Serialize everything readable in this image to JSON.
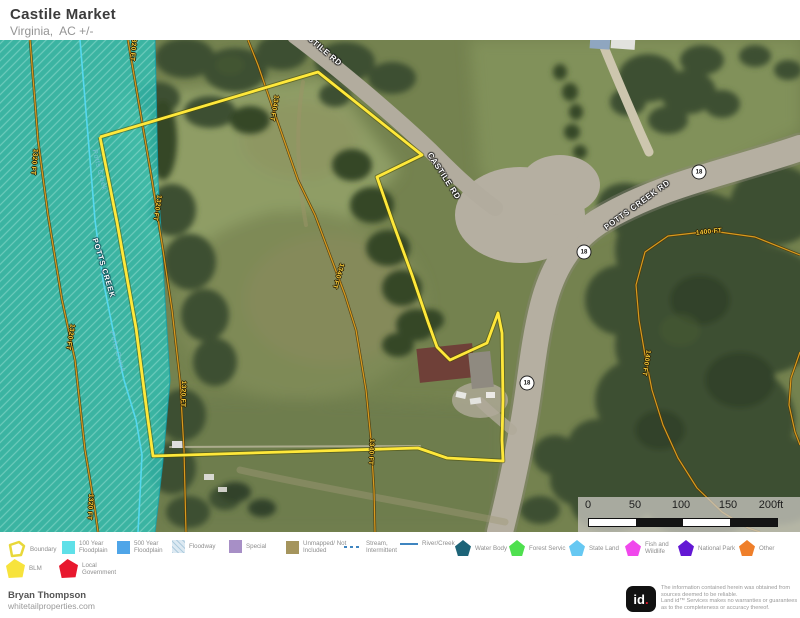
{
  "header": {
    "title": "Castile Market",
    "subtitle": "Virginia,  AC +/-"
  },
  "map": {
    "road_labels": [
      {
        "text": "CASTILE RD",
        "x": 320,
        "y": 7,
        "angle": 40,
        "kind": "road"
      },
      {
        "text": "CASTILE RD",
        "x": 444,
        "y": 136,
        "angle": 57,
        "kind": "road"
      },
      {
        "text": "POTTS CREEK RD",
        "x": 637,
        "y": 165,
        "angle": -36,
        "kind": "road"
      }
    ],
    "water_labels": [
      {
        "text": "POTTS CREEK",
        "x": 104,
        "y": 228,
        "angle": 73,
        "kind": "creek"
      },
      {
        "text": "Potts Creek",
        "x": 99,
        "y": 130,
        "angle": 76,
        "kind": "creek-faint"
      },
      {
        "text": "Potts Creek",
        "x": 117,
        "y": 312,
        "angle": 74,
        "kind": "creek-faint"
      }
    ],
    "contour_labels": [
      {
        "text": "1320 FT",
        "x": 133,
        "y": 8,
        "angle": 95
      },
      {
        "text": "1320 FT",
        "x": 34,
        "y": 122,
        "angle": 96
      },
      {
        "text": "1320 FT",
        "x": 157,
        "y": 168,
        "angle": 99
      },
      {
        "text": "1320 FT",
        "x": 70,
        "y": 297,
        "angle": 100
      },
      {
        "text": "1320 FT",
        "x": 183,
        "y": 354,
        "angle": 92
      },
      {
        "text": "1320 FT",
        "x": 90,
        "y": 467,
        "angle": 94
      },
      {
        "text": "1340 FT",
        "x": 274,
        "y": 68,
        "angle": 100
      },
      {
        "text": "1340 FT",
        "x": 338,
        "y": 236,
        "angle": 107
      },
      {
        "text": "1340 FT",
        "x": 371,
        "y": 412,
        "angle": 93
      },
      {
        "text": "1400 FT",
        "x": 709,
        "y": 192,
        "angle": -6
      },
      {
        "text": "1400 FT",
        "x": 646,
        "y": 323,
        "angle": 99
      }
    ],
    "shields": [
      {
        "label": "18",
        "x": 699,
        "y": 132
      },
      {
        "label": "18",
        "x": 584,
        "y": 212
      },
      {
        "label": "18",
        "x": 527,
        "y": 343
      }
    ],
    "scalebar": {
      "labels": [
        {
          "text": "0",
          "x": 10
        },
        {
          "text": "50",
          "x": 57
        },
        {
          "text": "100",
          "x": 103
        },
        {
          "text": "150",
          "x": 150
        },
        {
          "text": "200ft",
          "x": 193
        }
      ],
      "segments": [
        "#ffffff",
        "#141414",
        "#ffffff",
        "#141414"
      ]
    },
    "geometry": {
      "boundary": {
        "color": "#ffe83a",
        "points": "100,137 318,72 422,155 377,177 393,223 412,275 428,322 437,347 444,354 450,360 487,343 498,313 502,333 503,400 502,440 503,461 447,458 418,448 283,452 153,456 148,420 136,328 117,222 100,137"
      },
      "floodplain": {
        "fill": "#2ec0b4",
        "points": "0,40 155,40 158,180 165,300 170,380 163,460 155,532 0,532",
        "edge": "155,40 158,180 165,300 170,380 163,460 155,532",
        "edge_color": "#0fa3b0"
      },
      "creek": {
        "color": "#55d8ee",
        "points": "80,40 85,100 90,160 95,220 103,280 113,330 124,380 136,420 142,455 140,495 138,532"
      },
      "contours": [
        {
          "elevation": "1320 FT",
          "points": "30,40 38,140 48,215 62,300 75,360 85,450 95,510 98,532"
        },
        {
          "elevation": "1320 FT",
          "points": "128,40 140,110 152,180 163,250 172,310 180,380 184,450 186,532"
        },
        {
          "elevation": "1340 FT",
          "points": "248,40 258,65 270,100 284,140 298,180 315,215 330,255 345,295 356,330 366,390 371,440 374,490 375,532"
        },
        {
          "elevation": "1400 FT",
          "points": "800,255 755,237 712,231 668,236 645,252 636,285 639,320 645,355 652,390 663,425 678,458 697,488 722,512 748,528 760,532"
        },
        {
          "elevation": "1400 FT",
          "points": "800,352 791,378 789,405 795,432 800,445"
        }
      ]
    }
  },
  "legend": {
    "items": [
      {
        "label": "Boundary",
        "shape": "boundary",
        "color": "#e8d83a",
        "x": 6,
        "y": 8,
        "w": 40
      },
      {
        "label": "100 Year Floodplain",
        "shape": "square",
        "color": "#5fe0e8",
        "x": 62,
        "y": 8,
        "w": 40
      },
      {
        "label": "500 Year Floodplain",
        "shape": "square",
        "color": "#4fa5e8",
        "x": 117,
        "y": 8,
        "w": 40
      },
      {
        "label": "Floodway",
        "shape": "square-hatch",
        "color": "#dce9f2",
        "x": 172,
        "y": 8,
        "w": 44
      },
      {
        "label": "Special",
        "shape": "square",
        "color": "#a78fc6",
        "x": 229,
        "y": 8,
        "w": 40
      },
      {
        "label": "Unmapped/ Not Included",
        "shape": "square",
        "color": "#a5955d",
        "x": 286,
        "y": 8,
        "w": 48
      },
      {
        "label": "Stream, Intermittent",
        "shape": "dash-line",
        "color": "#3f85c0",
        "x": 344,
        "y": 8,
        "w": 38
      },
      {
        "label": "River/Creek",
        "shape": "solid-line",
        "color": "#3f85c0",
        "x": 400,
        "y": 8,
        "w": 44
      },
      {
        "label": "Water Body",
        "shape": "pentagon",
        "color": "#1d6478",
        "x": 455,
        "y": 8,
        "w": 40
      },
      {
        "label": "Forest Servic",
        "shape": "pentagon",
        "color": "#4fe04f",
        "x": 509,
        "y": 8,
        "w": 56
      },
      {
        "label": "State Land",
        "shape": "pentagon",
        "color": "#66c8f2",
        "x": 569,
        "y": 8,
        "w": 44
      },
      {
        "label": "Fish and Wildlife",
        "shape": "pentagon",
        "color": "#f048ec",
        "x": 625,
        "y": 8,
        "w": 34
      },
      {
        "label": "National Park",
        "shape": "pentagon",
        "color": "#6318d4",
        "x": 678,
        "y": 8,
        "w": 56
      },
      {
        "label": "Other",
        "shape": "pentagon",
        "color": "#ef7f2a",
        "x": 739,
        "y": 8,
        "w": 30
      },
      {
        "label": "BLM",
        "shape": "pentagon2",
        "color": "#f7e33c",
        "x": 6,
        "y": 27,
        "w": 30
      },
      {
        "label": "Local Government",
        "shape": "pentagon2",
        "color": "#e8182e",
        "x": 59,
        "y": 27,
        "w": 48
      }
    ]
  },
  "footer": {
    "author": "Bryan Thompson",
    "website": "whitetailproperties.com",
    "logo_text": "id",
    "logo_dot": ".",
    "disclaimer_lines": [
      "The information contained herein was obtained from",
      "sources deemed to be reliable.",
      " Land id™ Services makes no warranties or guarantees",
      "as to the completeness or accuracy thereof."
    ]
  }
}
